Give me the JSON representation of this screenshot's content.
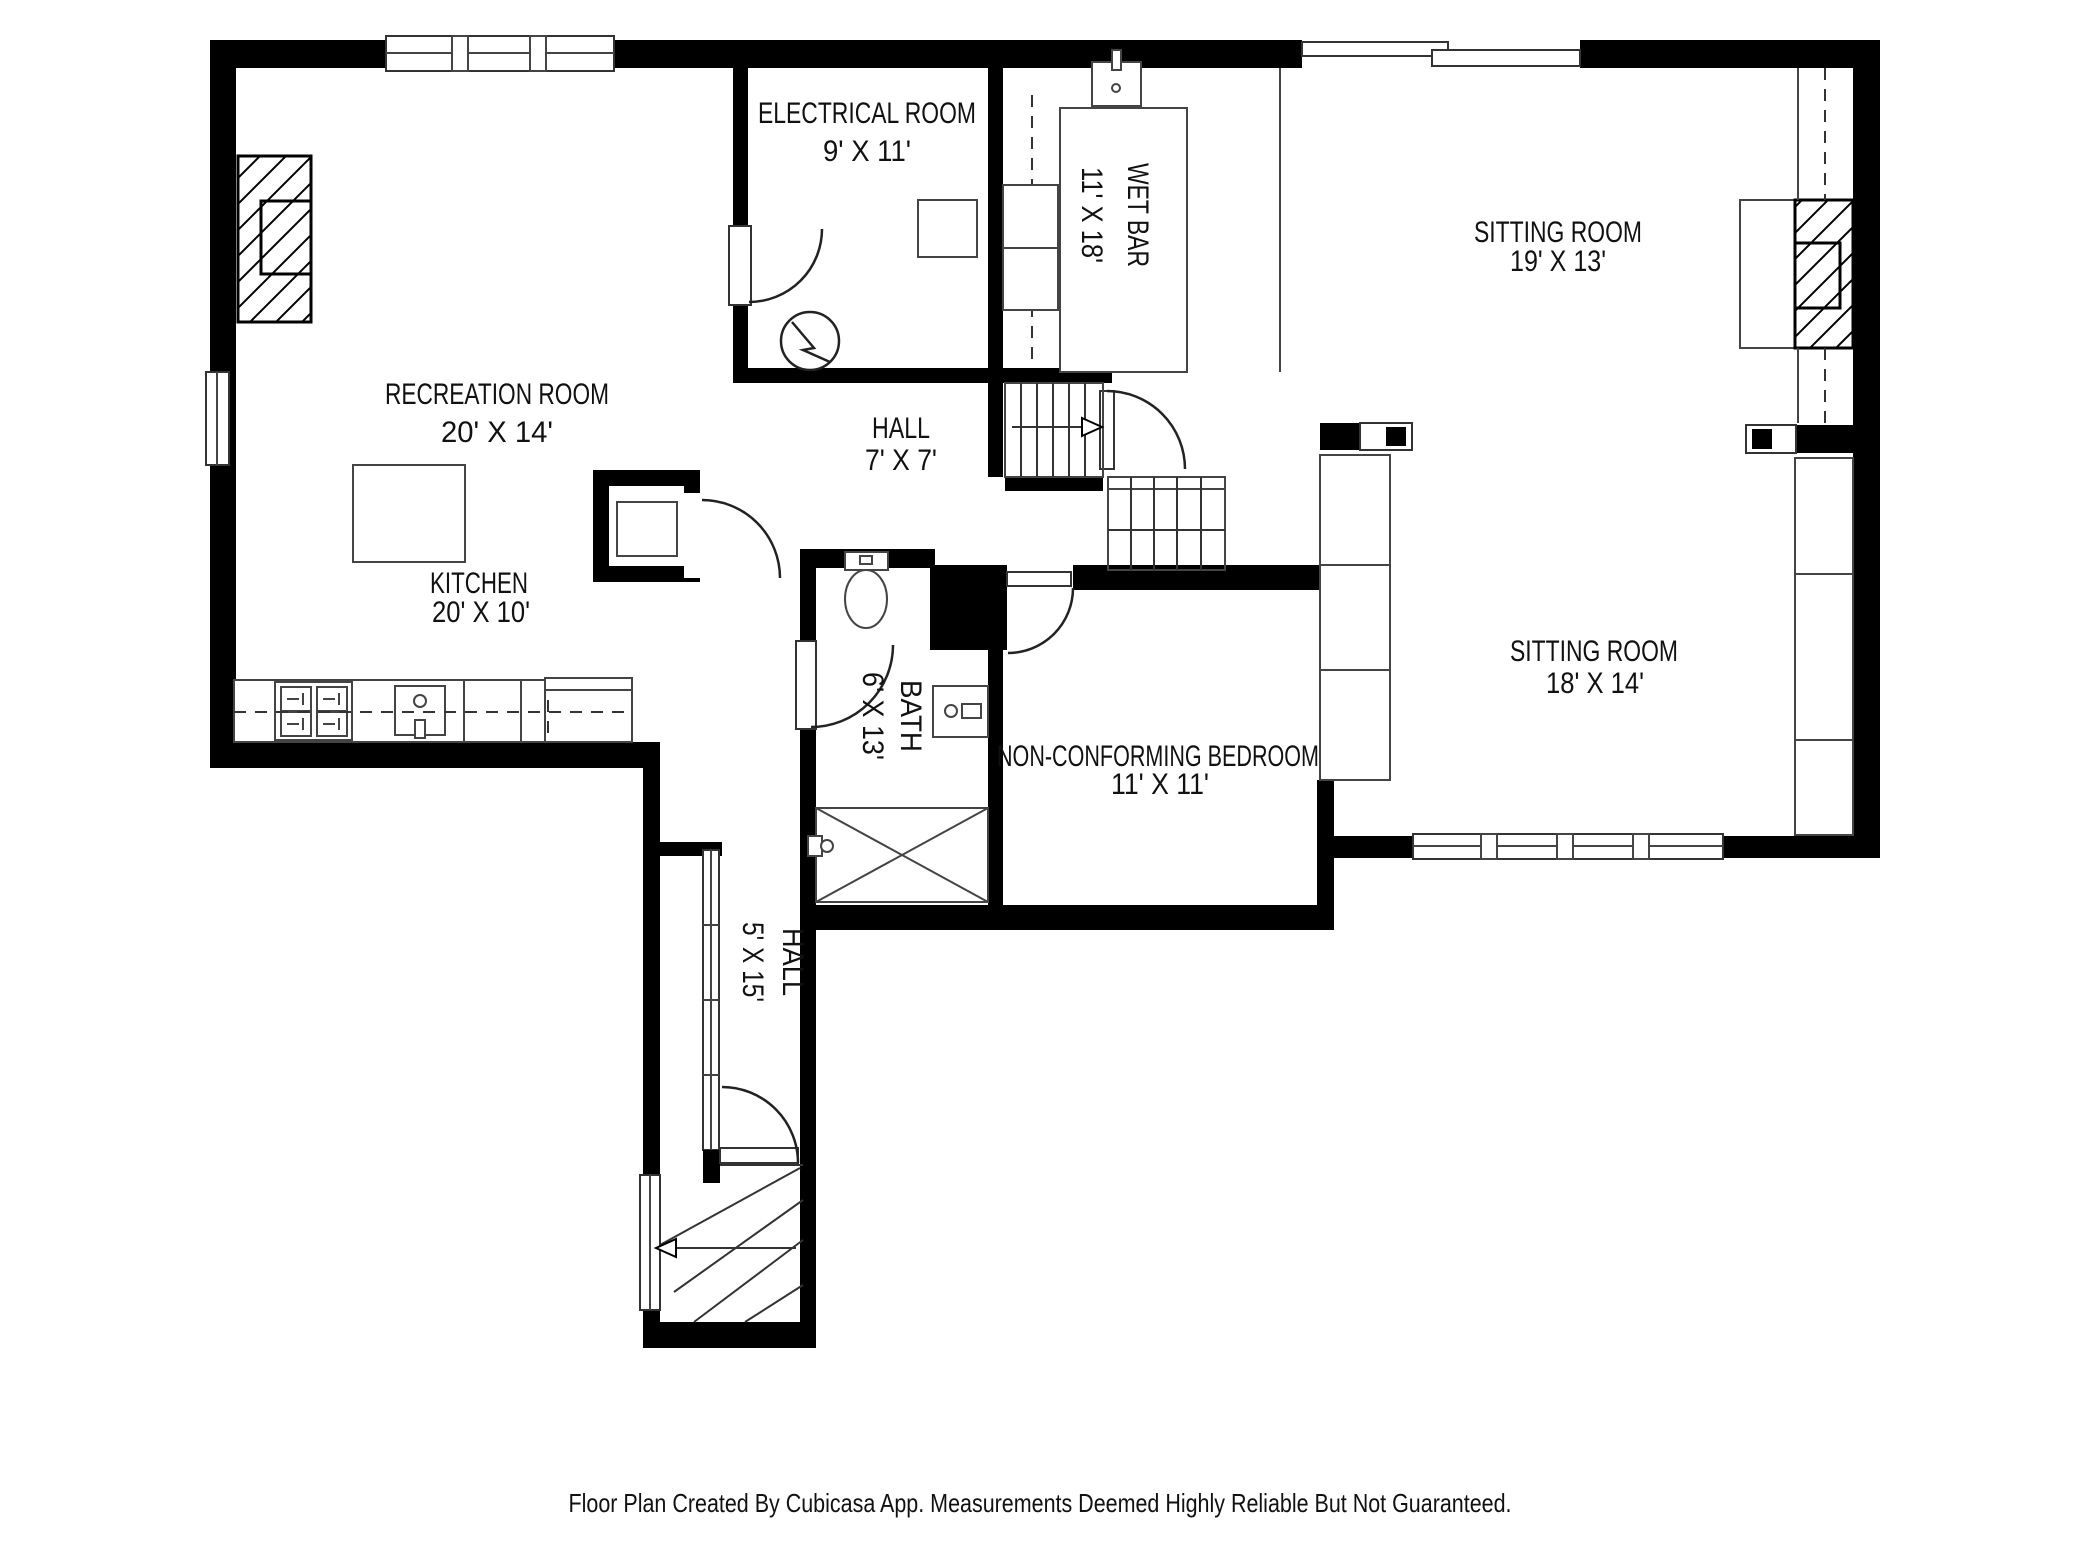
{
  "plan": {
    "rooms": [
      {
        "id": "recreation-room",
        "name": "RECREATION ROOM",
        "dims": "20' X 14'"
      },
      {
        "id": "electrical-room",
        "name": "ELECTRICAL ROOM",
        "dims": "9' X 11'"
      },
      {
        "id": "wet-bar",
        "name": "WET BAR",
        "dims": "11' X 18'"
      },
      {
        "id": "sitting-room-upper",
        "name": "SITTING ROOM",
        "dims": "19' X 13'"
      },
      {
        "id": "hall-upper",
        "name": "HALL",
        "dims": "7' X 7'"
      },
      {
        "id": "kitchen",
        "name": "KITCHEN",
        "dims": "20' X 10'"
      },
      {
        "id": "bath",
        "name": "BATH",
        "dims": "6' X 13'"
      },
      {
        "id": "non-conforming-bedroom",
        "name": "NON-CONFORMING BEDROOM",
        "dims": "11' X 11'"
      },
      {
        "id": "sitting-room-lower",
        "name": "SITTING ROOM",
        "dims": "18' X 14'"
      },
      {
        "id": "hall-lower",
        "name": "HALL",
        "dims": "5' X 15'"
      }
    ],
    "caption": "Floor Plan Created By Cubicasa App. Measurements Deemed Highly Reliable But Not Guaranteed."
  },
  "colors": {
    "wall": "#000000",
    "furniture_line": "#444444",
    "text": "#111111",
    "background": "#ffffff"
  }
}
